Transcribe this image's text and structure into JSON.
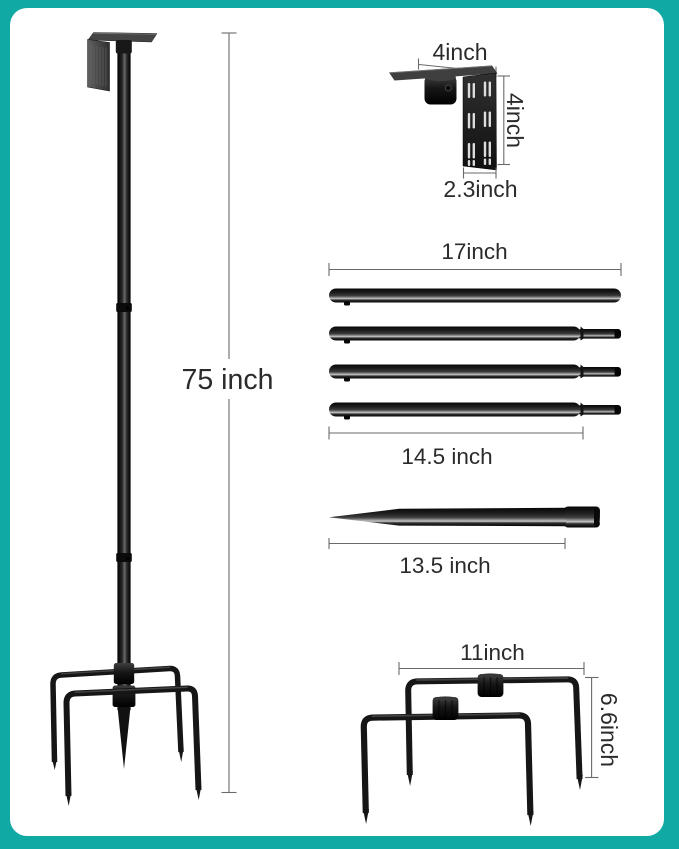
{
  "colors": {
    "frame_teal": "#10a9a4",
    "panel_white": "#ffffff",
    "metal_black": "#161616",
    "dimension_line_gray": "#6a6a6a",
    "label_text": "#2b2b2b"
  },
  "figures": {
    "assembled_pole": {
      "height_label": "75 inch"
    },
    "mounting_bracket": {
      "width_label": "4inch",
      "height_label": "4inch",
      "base_depth_label": "2.3inch"
    },
    "pole_segments": {
      "segment_count": 4,
      "full_length_label": "17inch",
      "body_length_label": "14.5 inch"
    },
    "ground_spike": {
      "length_label": "13.5 inch"
    },
    "prong_base": {
      "width_label": "11inch",
      "height_label": "6.6inch"
    }
  }
}
